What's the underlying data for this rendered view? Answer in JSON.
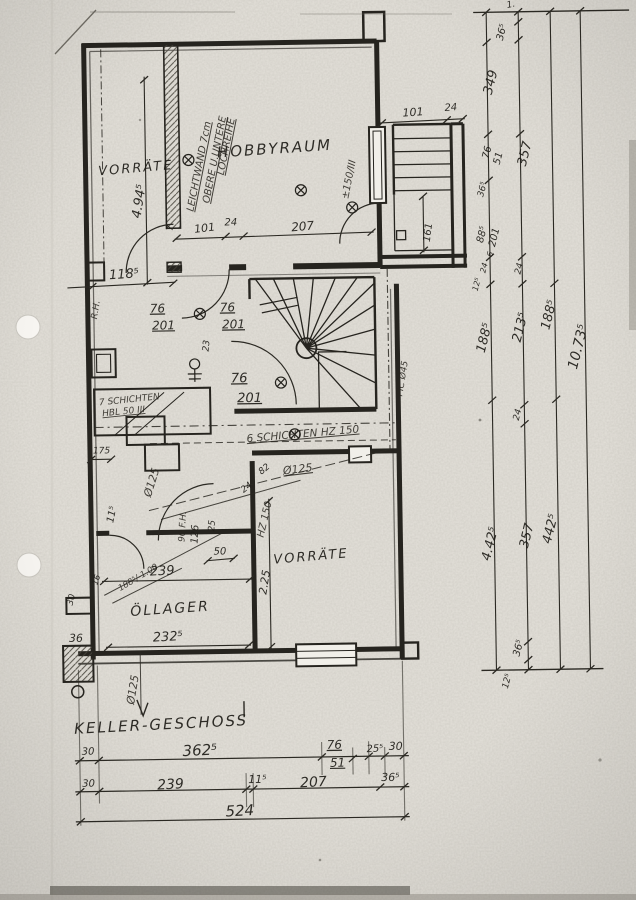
{
  "meta": {
    "sheet_title": "KELLER-GESCHOSS"
  },
  "rooms": {
    "vorraete_top": "VORRÄTE",
    "hobbyraum": "HOBBYRAUM",
    "oellager": "ÖLLAGER",
    "vorraete_bottom": "VORRÄTE"
  },
  "notes": {
    "leichtwand_1": "LEICHTWAND 7cm",
    "leichtwand_2": "OBERE U.UNTERE",
    "leichtwand_3": "LOCHREIHE",
    "schichten_left_1": "7 SCHICHTEN",
    "schichten_left_2": "HBL 50 III",
    "schichten_right": "6 SCHICHTEN HZ 150",
    "window_mark": "±150/III",
    "rh": "R.H.",
    "fh": "90 F.H.",
    "hz150": "HZ 150",
    "pic45": "PIC Ø45",
    "level_note": "188⁵/-1.00",
    "dia125_a": "Ø125",
    "dia125_b": "Ø125",
    "dia125_c": "Ø125"
  },
  "dims": {
    "inner": {
      "d118": "118⁵",
      "d494": "4.94⁵",
      "d7": "7",
      "d101": "101",
      "d24a": "24",
      "d207": "207",
      "door1_w": "76",
      "door1_h": "201",
      "door2_w": "76",
      "door2_h": "201",
      "door3_w": "76",
      "door3_h": "201",
      "d23": "23",
      "d175": "175",
      "d115": "11⁵",
      "d126": "126",
      "d25": "25",
      "d24b": "24",
      "d82": "82",
      "d50": "50",
      "d239": "239",
      "d2325": "232⁵",
      "d225": "2.25",
      "d16": "16",
      "d30a": "30",
      "d36a": "36",
      "annex_101": "101",
      "annex_24": "24",
      "annex_161": "161"
    },
    "right": {
      "r1": "1.",
      "r365a": "36⁵",
      "r349": "349",
      "r76": "76",
      "r51": "51",
      "r365b": "36⁵",
      "r885": "88⁵",
      "r201": "201",
      "r6": "6",
      "r24a": "24",
      "r125a": "12⁵",
      "r1885a": "188⁵",
      "r4425a": "4.42⁵",
      "r125b": "12⁵",
      "r357a": "357",
      "r24b": "24",
      "r2135": "213⁵",
      "r24c": "24",
      "r357b": "357",
      "r365c": "36⁵",
      "r1885b": "188⁵",
      "r4425b": "442⁵",
      "r10735": "10.73⁵"
    },
    "bottom": {
      "row1": [
        "30",
        "362⁵",
        "76",
        "51",
        "25⁵",
        "30"
      ],
      "row2": [
        "30",
        "239",
        "11⁵",
        "207",
        "36⁵"
      ],
      "row3": [
        "524"
      ]
    }
  }
}
